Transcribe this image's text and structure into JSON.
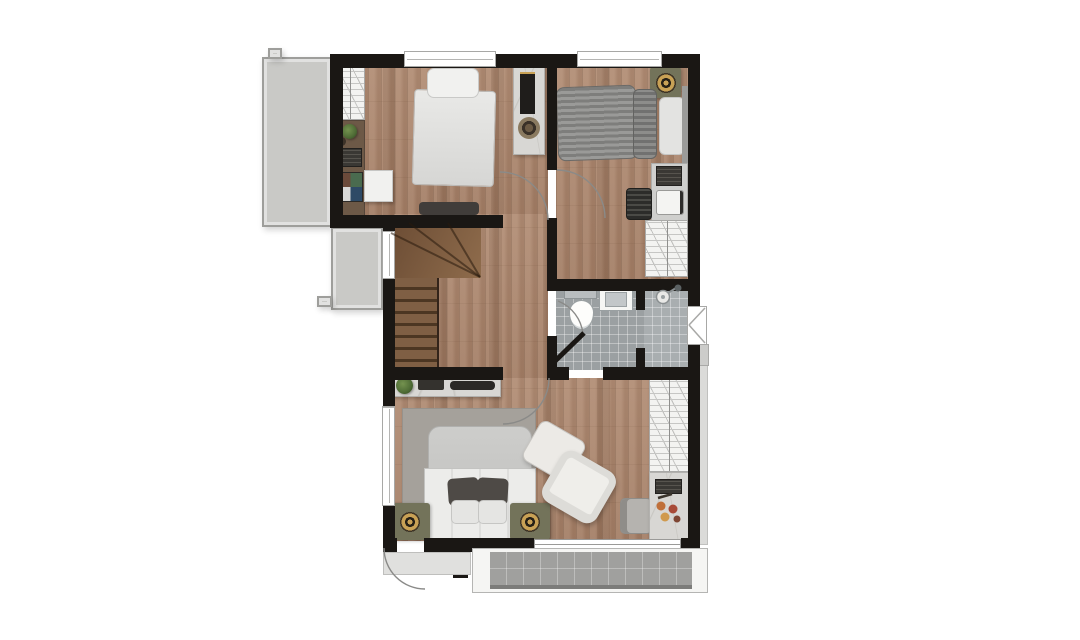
{
  "document": {
    "type": "architectural-floor-plan",
    "visible_text": [],
    "background": "#ffffff"
  },
  "colors": {
    "wall": "#1a1714",
    "wood-base": "#b18d75",
    "wood-shade": "#a37e66",
    "tile-bath": "#9ba0a2",
    "tile-shower": "#a9aeb0",
    "balcony-tile": "#a0a09e",
    "concrete": "#c9c9c6",
    "concrete-border": "#9e9e9b",
    "wardrobe": "#f3f3f1",
    "wardrobe-line": "#c6c6c4",
    "marble": "#d8d7d4",
    "desk-brown": "#6d5947",
    "rug": "#a5a19b",
    "bed-white": "#ececea",
    "bed-gray": "#c6c6c4",
    "stripe-a": "#9a9a98",
    "stripe-b": "#7e7e7c",
    "pillow-dark": "#4e4a46",
    "olive": "#73735a",
    "gold": "#c8a155",
    "plant": "#4e6b35",
    "chair-dark": "#2f2f2d",
    "arc": "#8a8a88"
  },
  "rooms": [
    {
      "name": "bedroom-1",
      "furniture": [
        "single-bed",
        "hatched-wardrobe",
        "wall-desk",
        "plant",
        "books",
        "art-board",
        "nightstand",
        "marble-tv-console",
        "foot-bench"
      ]
    },
    {
      "name": "bedroom-2",
      "furniture": [
        "single-bed-striped",
        "speaker-on-stand",
        "desk-with-laptop",
        "slatted-chair",
        "hatched-wardrobe"
      ]
    },
    {
      "name": "hallway",
      "furniture": [
        "l-shaped-staircase",
        "console-with-plant"
      ]
    },
    {
      "name": "bathroom",
      "fixtures": [
        "toilet",
        "sink",
        "shower",
        "casement-window"
      ]
    },
    {
      "name": "master-bedroom",
      "furniture": [
        "double-bed",
        "area-rug",
        "nightstand-left",
        "nightstand-right",
        "armchair",
        "ottoman",
        "vanity-chair",
        "vanity-with-cosmetics",
        "hatched-wardrobe"
      ]
    },
    {
      "name": "balcony-upper-left",
      "furniture": []
    },
    {
      "name": "roof-ledge-left",
      "furniture": []
    },
    {
      "name": "balcony-bottom",
      "furniture": []
    }
  ],
  "stairs": {
    "shape": "L-shaped-with-winders",
    "straight-treads": 8
  },
  "doors": [
    "bedroom-1-door",
    "bedroom-2-door",
    "bathroom-door",
    "master-bedroom-door",
    "exterior-bottom-left-door",
    "balcony-sliding-door"
  ],
  "windows": [
    "top-window-bedroom-1",
    "top-window-bedroom-2",
    "stair-west-window",
    "master-west-window",
    "bathroom-east-casement-window"
  ]
}
